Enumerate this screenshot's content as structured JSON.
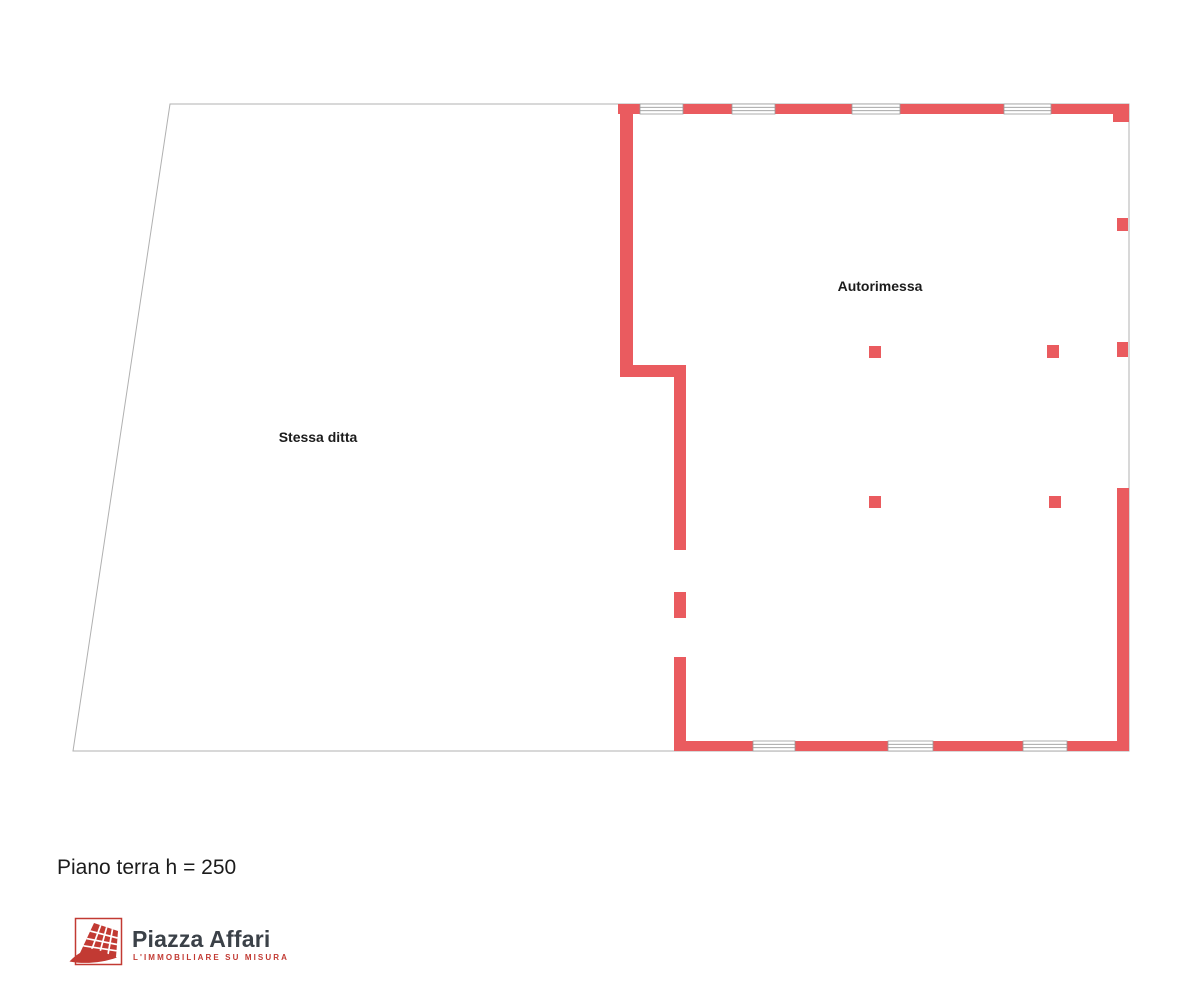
{
  "plan": {
    "room_labels": {
      "garage": "Autorimessa",
      "left_area": "Stessa ditta"
    },
    "floor_label": "Piano terra h = 250"
  },
  "branding": {
    "name": "Piazza Affari",
    "tagline": "L'IMMOBILIARE SU MISURA"
  },
  "icons": {
    "logo_icon": "building-grid-icon"
  },
  "colors": {
    "wall": "#ea5b5f",
    "outline": "#b0b0b0",
    "winline": "#9a9a9a",
    "label": "#1c1c1c",
    "logored": "#c23a33",
    "logotext": "#3b4148"
  }
}
